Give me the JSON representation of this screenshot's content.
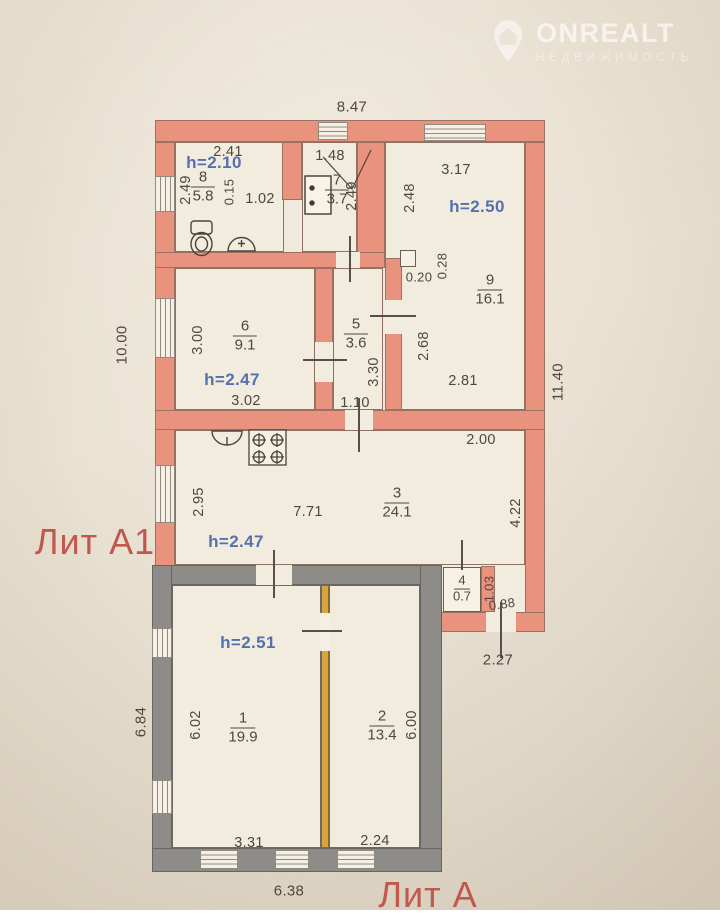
{
  "watermark": {
    "brand": "ONREALT",
    "tagline": "НЕДВИЖИМОСТЬ"
  },
  "colors": {
    "wall_a1": "#e9937f",
    "wall_a": "#8d8c88",
    "partition": "#d8a53d",
    "height_text": "#5570b0",
    "lit_text": "#c2574e",
    "dim_text": "#4f473f"
  },
  "plan": {
    "building_labels": [
      {
        "name": "lit-a1-label",
        "text": "Лит А1",
        "x": 95,
        "y": 542
      },
      {
        "name": "lit-a-label",
        "text": "Лит А",
        "x": 428,
        "y": 895
      }
    ],
    "rooms": [
      {
        "number": "8",
        "area": "5.8",
        "x": 203,
        "y": 187,
        "height": "h=2.10",
        "hx": 214,
        "hy": 163
      },
      {
        "number": "7",
        "area": "3.7",
        "x": 337,
        "y": 190
      },
      {
        "number": "9",
        "area": "16.1",
        "x": 490,
        "y": 290,
        "height": "h=2.50",
        "hx": 477,
        "hy": 207
      },
      {
        "number": "6",
        "area": "9.1",
        "x": 245,
        "y": 336,
        "height": "h=2.47",
        "hx": 232,
        "hy": 380
      },
      {
        "number": "5",
        "area": "3.6",
        "x": 356,
        "y": 334
      },
      {
        "number": "3",
        "area": "24.1",
        "x": 397,
        "y": 503,
        "height": "h=2.47",
        "hx": 236,
        "hy": 542
      },
      {
        "number": "4",
        "area": "0.7",
        "x": 462,
        "y": 589,
        "small": true
      },
      {
        "number": "1",
        "area": "19.9",
        "x": 243,
        "y": 728,
        "height": "h=2.51",
        "hx": 248,
        "hy": 643
      },
      {
        "number": "2",
        "area": "13.4",
        "x": 382,
        "y": 726
      }
    ],
    "dimensions": [
      {
        "name": "dim-overall-top",
        "text": "8.47",
        "x": 352,
        "y": 107,
        "size": 15
      },
      {
        "name": "dim-room8-top",
        "text": "2.41",
        "x": 228,
        "y": 152
      },
      {
        "name": "dim-room8-left",
        "text": "2.49",
        "x": 186,
        "y": 190,
        "rot": -90
      },
      {
        "name": "dim-room8-partition",
        "text": "0.15",
        "x": 229,
        "y": 192,
        "rot": -90,
        "size": 13
      },
      {
        "name": "dim-room8-bottom",
        "text": "1.02",
        "x": 260,
        "y": 199
      },
      {
        "name": "dim-room7-top",
        "text": "1.48",
        "x": 330,
        "y": 156
      },
      {
        "name": "dim-room7-right",
        "text": "2.49",
        "x": 352,
        "y": 196,
        "rot": -90
      },
      {
        "name": "dim-room9-top",
        "text": "3.17",
        "x": 456,
        "y": 170
      },
      {
        "name": "dim-room9-left",
        "text": "2.48",
        "x": 410,
        "y": 198,
        "rot": -90
      },
      {
        "name": "dim-niche-width",
        "text": "0.20",
        "x": 419,
        "y": 277,
        "size": 13
      },
      {
        "name": "dim-niche-depth",
        "text": "0.28",
        "x": 442,
        "y": 266,
        "rot": -90,
        "size": 13
      },
      {
        "name": "dim-room9-left-lower",
        "text": "2.68",
        "x": 424,
        "y": 346,
        "rot": -90
      },
      {
        "name": "dim-room9-bottom",
        "text": "2.81",
        "x": 463,
        "y": 381
      },
      {
        "name": "dim-overall-right",
        "text": "11.40",
        "x": 558,
        "y": 382,
        "rot": -90,
        "size": 15
      },
      {
        "name": "dim-overall-left",
        "text": "10.00",
        "x": 122,
        "y": 345,
        "rot": -90,
        "size": 15
      },
      {
        "name": "dim-room6-left",
        "text": "3.00",
        "x": 198,
        "y": 340,
        "rot": -90
      },
      {
        "name": "dim-room6-bottom",
        "text": "3.02",
        "x": 246,
        "y": 401
      },
      {
        "name": "dim-room5-right",
        "text": "3.30",
        "x": 374,
        "y": 372,
        "rot": -90
      },
      {
        "name": "dim-room5-bottom",
        "text": "1.10",
        "x": 355,
        "y": 403
      },
      {
        "name": "dim-room3-top",
        "text": "2.00",
        "x": 481,
        "y": 440
      },
      {
        "name": "dim-room3-left",
        "text": "2.95",
        "x": 199,
        "y": 502,
        "rot": -90
      },
      {
        "name": "dim-room3-width",
        "text": "7.71",
        "x": 308,
        "y": 512
      },
      {
        "name": "dim-room3-right",
        "text": "4.22",
        "x": 516,
        "y": 513,
        "rot": -90
      },
      {
        "name": "dim-room4-right",
        "text": "1.03",
        "x": 489,
        "y": 589,
        "rot": -90,
        "size": 13
      },
      {
        "name": "dim-room4-gap",
        "text": "0.88",
        "x": 502,
        "y": 604,
        "rot": -8,
        "size": 13
      },
      {
        "name": "dim-porch-width",
        "text": "2.27",
        "x": 498,
        "y": 660,
        "size": 15
      },
      {
        "name": "dim-room1-left",
        "text": "6.02",
        "x": 196,
        "y": 725,
        "rot": -90
      },
      {
        "name": "dim-overall-left-a",
        "text": "6.84",
        "x": 141,
        "y": 722,
        "rot": -90,
        "size": 15
      },
      {
        "name": "dim-room2-right",
        "text": "6.00",
        "x": 412,
        "y": 725,
        "rot": -90
      },
      {
        "name": "dim-room1-bottom",
        "text": "3.31",
        "x": 249,
        "y": 843
      },
      {
        "name": "dim-room2-bottom",
        "text": "2.24",
        "x": 375,
        "y": 841
      },
      {
        "name": "dim-overall-bottom",
        "text": "6.38",
        "x": 289,
        "y": 891,
        "size": 15
      }
    ]
  }
}
